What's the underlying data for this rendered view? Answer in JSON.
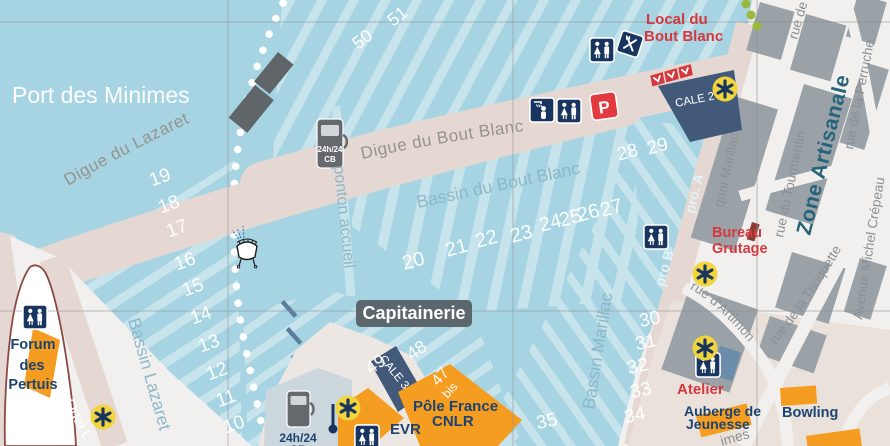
{
  "map": {
    "title": "Port des Minimes",
    "water_labels": {
      "bassin_bout_blanc": "Bassin du Bout Blanc",
      "bassin_lazaret": "Bassin Lazaret",
      "bassin_marillac": "Bassin Marillac",
      "ponton_accueil": "ponton accueil",
      "pro_a": "pro. A",
      "pro_b": "pro B"
    },
    "dikes": {
      "digue_lazaret": "Digue du Lazaret",
      "digue_bout_blanc": "Digue du Bout Blanc"
    },
    "streets": {
      "quai_marillac": "quai Marillac",
      "rue_du_tourmentin": "rue du Tourmentin",
      "rue_de_la_perruche": "rue de la Perruche",
      "avenue_michel_crepeau": "Avenue Michel Crépeau",
      "rue_de_la_trinquette": "rue de la Trinquette",
      "rue_d_artimon": "rue d'Artimon",
      "rue_partial": "rue de",
      "avenue_minimes_partial": "imes",
      "quai_l": "Quai L"
    },
    "district": {
      "zone_artisanale": "Zone Artisanale"
    },
    "pois": {
      "capitainerie": "Capitainerie",
      "local_bout_blanc_line1": "Local du",
      "local_bout_blanc_line2": "Bout Blanc",
      "bureau_grutage_line1": "Bureau",
      "bureau_grutage_line2": "Grutage",
      "atelier": "Atelier",
      "auberge_line1": "Auberge de",
      "auberge_line2": "Jeunesse",
      "bowling": "Bowling",
      "forum_line1": "Forum",
      "forum_line2": "des",
      "forum_line3": "Pertuis",
      "pole_france_line1": "Pôle France",
      "pole_france_line2": "CNLR",
      "evr": "EVR",
      "cale_2": "CALE 2",
      "cale_3": "CALE 3"
    },
    "fuel": {
      "line1": "24h/24",
      "line2": "CB"
    },
    "parking_letter": "P",
    "pontoon_numbers": [
      "10",
      "11",
      "12",
      "13",
      "14",
      "15",
      "16",
      "17",
      "18",
      "19",
      "20",
      "21",
      "22",
      "23",
      "24",
      "25",
      "26",
      "27",
      "28",
      "29",
      "30",
      "31",
      "32",
      "33",
      "34",
      "35",
      "48",
      "49",
      "50",
      "51",
      "47",
      "bis"
    ],
    "icons": [
      "wc-icon",
      "shower-icon",
      "restaurant-icon",
      "parking-icon",
      "fuel-station-icon",
      "crane-icon",
      "slipway-flag-icon",
      "boat-icon",
      "green-buoy-icon"
    ],
    "colors": {
      "water": "#a7d4e2",
      "pontoon_stripe": "#c7e4ec",
      "dike": "#e5d8d3",
      "land": "#f2f0ee",
      "building_gray": "#9aa1a7",
      "building_orange": "#f59d20",
      "navy": "#17355f",
      "red": "#d5393f",
      "crane_yellow": "#f2d43d",
      "district_label": "#26647b"
    }
  }
}
